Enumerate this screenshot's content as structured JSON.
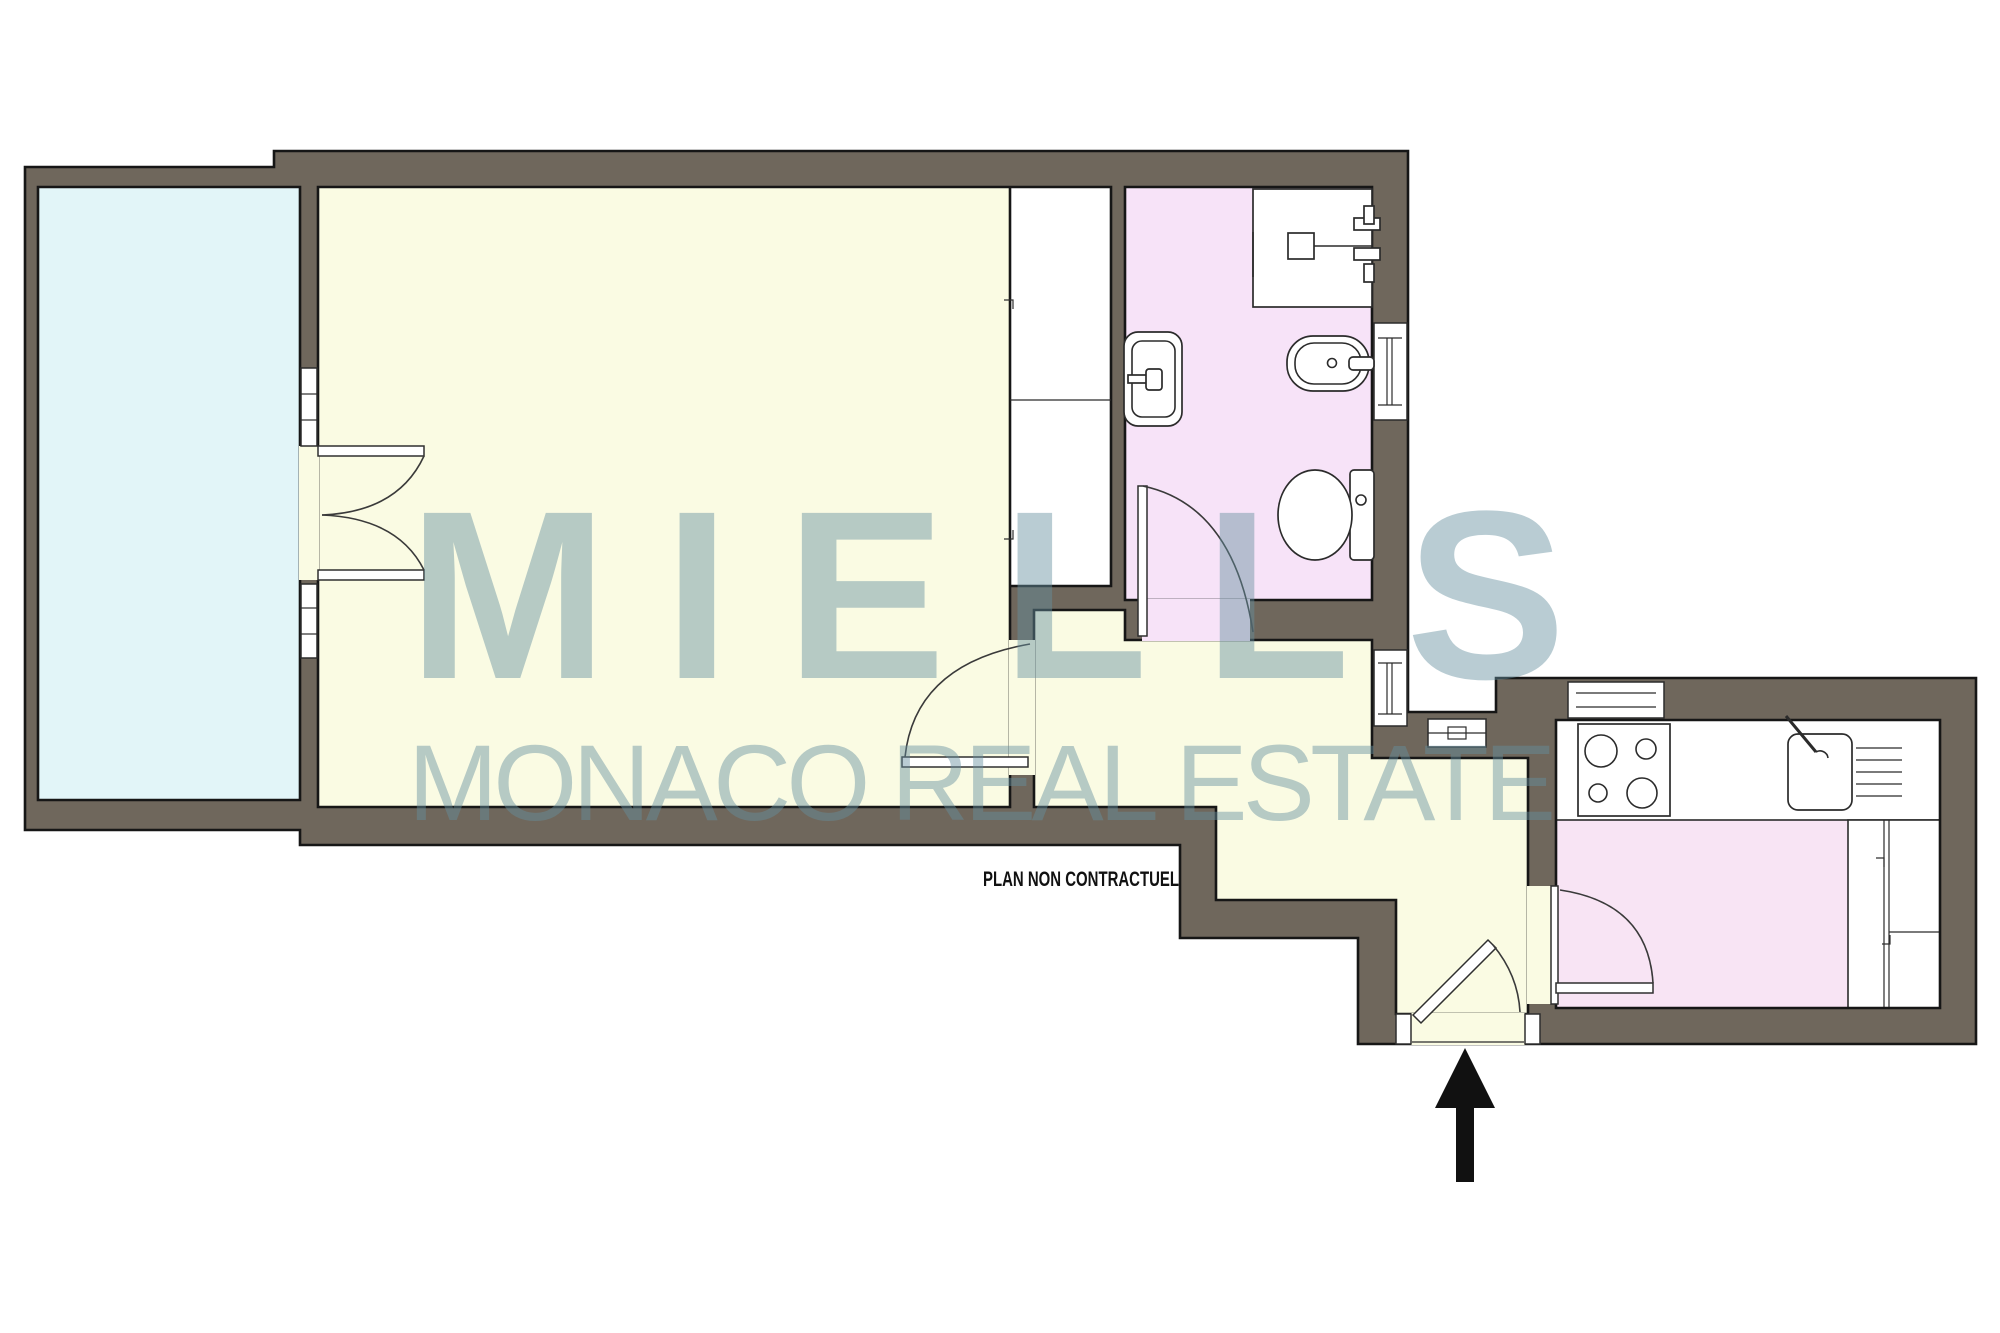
{
  "palette": {
    "wall": "#6F675C",
    "wall_outline": "#161616",
    "line": "#2b2b2b",
    "floor_main": "#FAFBE3",
    "floor_terrace": "#E2F5F8",
    "floor_bath": "#F7E3F8",
    "floor_kitchen": "#F8E4F4",
    "fixture_white": "#FFFFFF",
    "watermark": "#66909F",
    "arrow": "#111111",
    "background": "#FFFFFF"
  },
  "watermark": {
    "line1": "MIELLS",
    "line2": "MONACO REAL ESTATE",
    "opacity": "0.45"
  },
  "disclaimer": {
    "text": "PLAN NON CONTRACTUEL"
  },
  "plan": {
    "rooms": [
      {
        "name": "terrace"
      },
      {
        "name": "main-room"
      },
      {
        "name": "wardrobe"
      },
      {
        "name": "bathroom"
      },
      {
        "name": "hallway-entrance"
      },
      {
        "name": "kitchen"
      }
    ],
    "fixtures": [
      "shower",
      "washbasin",
      "bidet",
      "toilet",
      "stove-4-burners",
      "kitchen-sink",
      "l-shaped-counter",
      "wardrobe-shelf"
    ],
    "doors": [
      "french-doors-terrace",
      "main-room-door",
      "bathroom-door",
      "kitchen-door",
      "entrance-door"
    ],
    "windows": [
      "terrace-window-upper",
      "terrace-window-lower",
      "bathroom-window",
      "hallway-window",
      "kitchen-window",
      "hallway-sill"
    ],
    "entrance_arrow_direction": "up"
  }
}
